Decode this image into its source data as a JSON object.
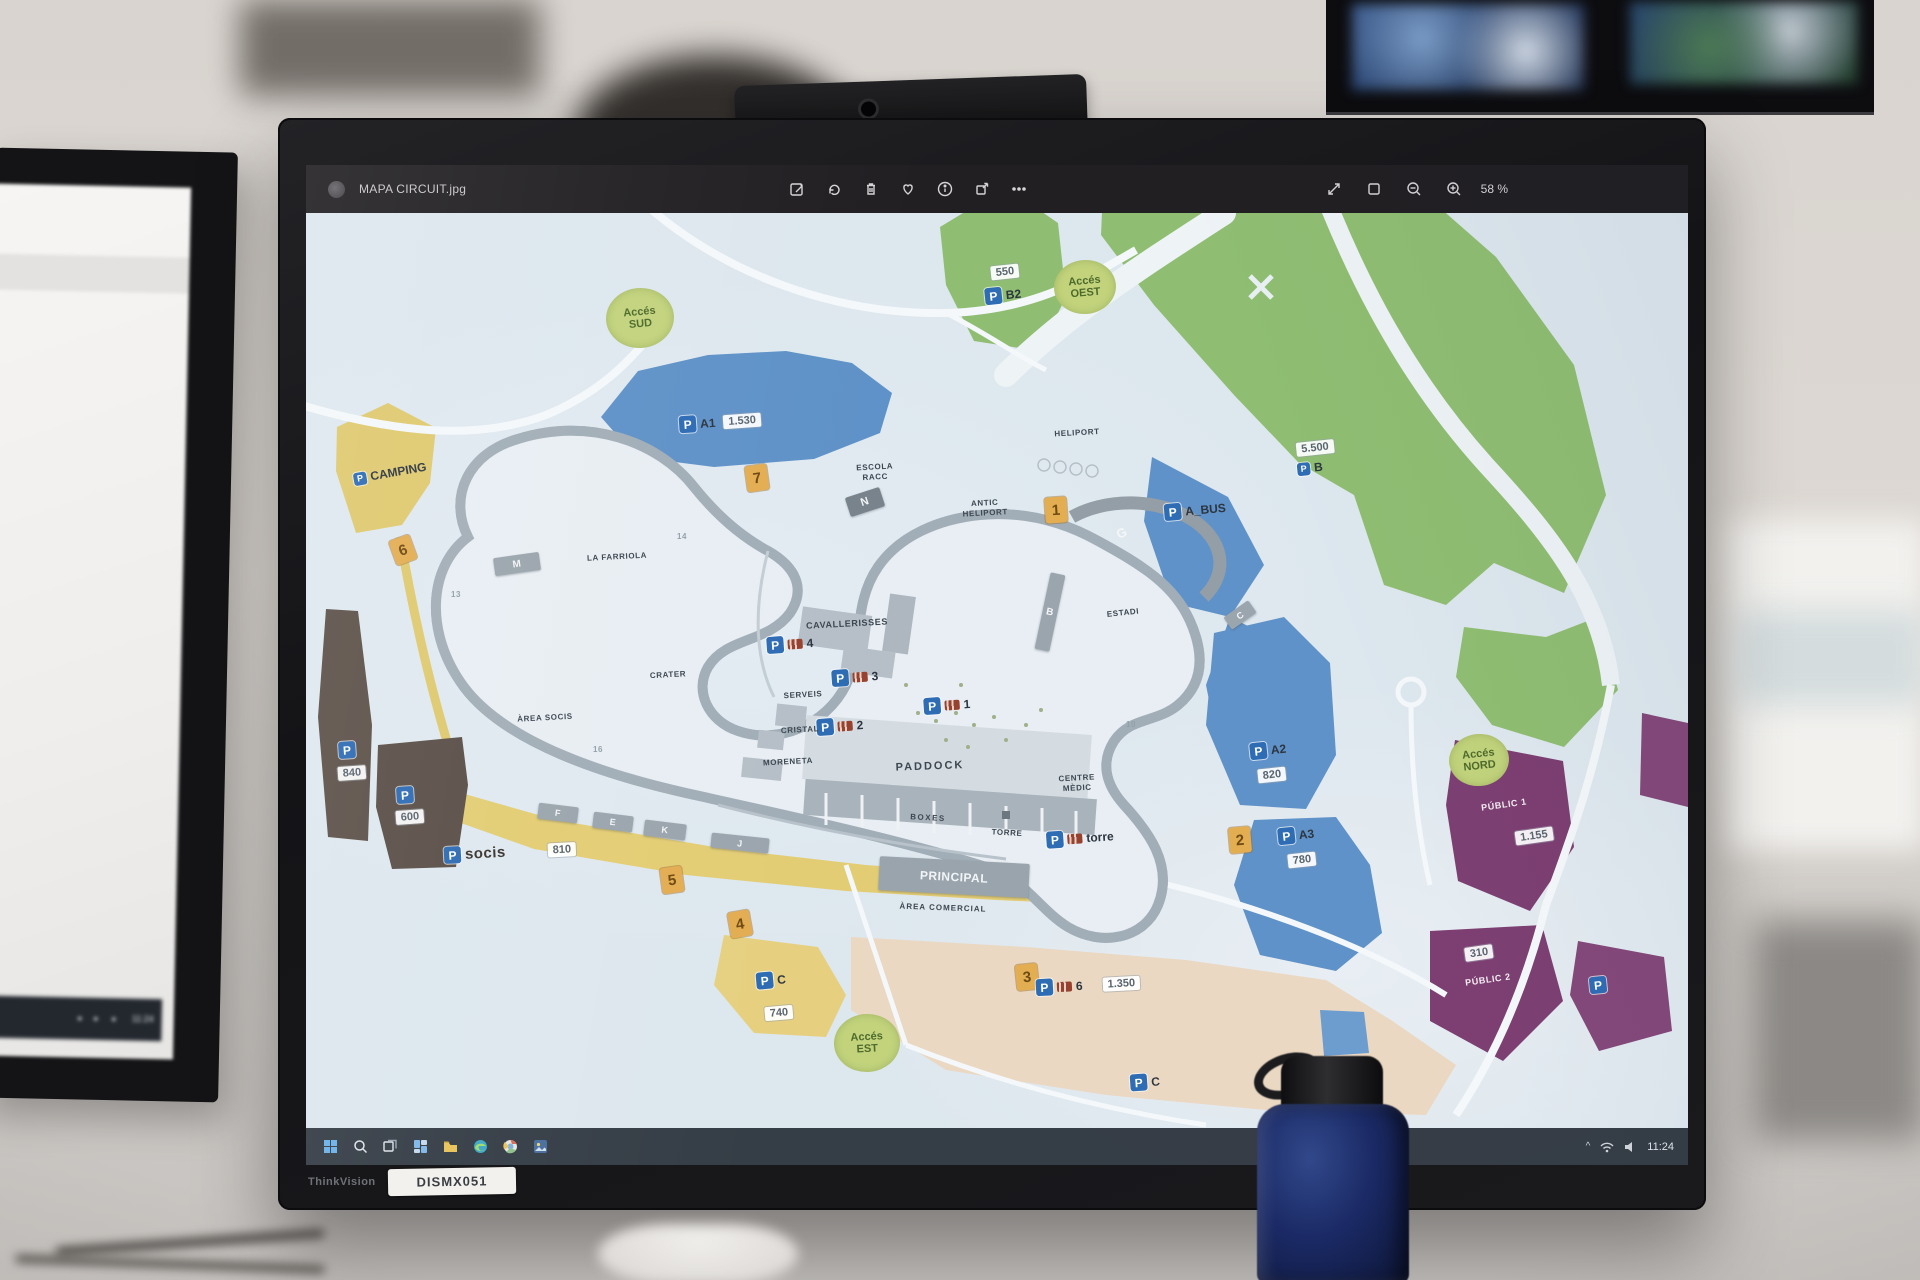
{
  "app": {
    "title": "MAPA CIRCUIT.jpg",
    "toolbar": [
      {
        "name": "edit-icon",
        "label": "Edit"
      },
      {
        "name": "rotate-icon",
        "label": "Rotate"
      },
      {
        "name": "delete-icon",
        "label": "Delete"
      },
      {
        "name": "favorite-icon",
        "label": "Favourite"
      },
      {
        "name": "info-icon",
        "label": "Info"
      },
      {
        "name": "share-icon",
        "label": "Share"
      },
      {
        "name": "more-icon",
        "label": "More"
      }
    ],
    "zoom_controls": [
      "fullscreen",
      "fit-to-window",
      "zoom-out",
      "zoom-in"
    ],
    "zoom_level": "58 %"
  },
  "windows_taskbar": {
    "icons": [
      "start",
      "search",
      "task-view",
      "widgets",
      "file-explorer",
      "edge",
      "chrome",
      "photos"
    ],
    "tray_caret": "^",
    "time": "11:24"
  },
  "left_monitor": {
    "time": "11:24"
  },
  "monitor": {
    "brand": "ThinkVision",
    "asset_tag": "DISMX051"
  },
  "map": {
    "colors": {
      "background": "#dde7ee",
      "vegetation_green": "#8fbe72",
      "parking_blue": "#5f92c8",
      "p_badge_blue": "#2e6cb4",
      "camping_yellow": "#dfc96f",
      "commercial_beige": "#ead8c2",
      "parking_brown": "#5d524a",
      "public_purple": "#7d3f72",
      "access_circle_green": "#c2d37c",
      "gate_orange": "#e3ad52"
    },
    "access_points": [
      {
        "t": "access",
        "lines": [
          "Accés",
          "SUD"
        ],
        "x": 334,
        "y": 153,
        "rx": 34,
        "ry": 30,
        "rot": -5
      },
      {
        "t": "access",
        "lines": [
          "Accés",
          "OEST"
        ],
        "x": 779,
        "y": 122,
        "rx": 31,
        "ry": 27,
        "rot": -5
      },
      {
        "t": "access",
        "lines": [
          "Accés",
          "NORD"
        ],
        "x": 1173,
        "y": 595,
        "rx": 30,
        "ry": 26,
        "rot": -6
      },
      {
        "t": "access",
        "lines": [
          "Accés",
          "EST"
        ],
        "x": 561,
        "y": 878,
        "rx": 33,
        "ry": 29,
        "rot": -3
      }
    ],
    "gates": [
      {
        "t": "gate",
        "n": "1",
        "x": 750,
        "y": 345,
        "rot": -4
      },
      {
        "t": "gate",
        "n": "2",
        "x": 934,
        "y": 675,
        "rot": -5
      },
      {
        "t": "gate",
        "n": "3",
        "x": 721,
        "y": 812,
        "rot": -6
      },
      {
        "t": "gate",
        "n": "4",
        "x": 434,
        "y": 759,
        "rot": -10
      },
      {
        "t": "gate",
        "n": "5",
        "x": 366,
        "y": 715,
        "rot": -8
      },
      {
        "t": "gate",
        "n": "6",
        "x": 97,
        "y": 385,
        "rot": -20
      },
      {
        "t": "gate",
        "n": "7",
        "x": 451,
        "y": 313,
        "rot": -8
      }
    ],
    "parking_badges": [
      {
        "t": "p",
        "x": 414,
        "y": 257,
        "kind": "text",
        "text": "A1",
        "badge": "1.530",
        "rot": -4
      },
      {
        "t": "wbadge",
        "x": 699,
        "y": 107,
        "text": "550",
        "rot": -6
      },
      {
        "t": "p",
        "x": 697,
        "y": 130,
        "kind": "text",
        "text": "B2",
        "rot": -6
      },
      {
        "t": "wbadge",
        "x": 1009,
        "y": 283,
        "text": "5.500",
        "rot": -6
      },
      {
        "t": "p",
        "x": 1004,
        "y": 303,
        "kind": "text",
        "text": "B",
        "small": true,
        "rot": -6
      },
      {
        "t": "p",
        "x": 889,
        "y": 345,
        "kind": "text",
        "text": "A_BUS",
        "rot": -5
      },
      {
        "t": "p",
        "x": 84,
        "y": 308,
        "kind": "text",
        "text": "CAMPING",
        "small": true,
        "rot": -10
      },
      {
        "t": "p",
        "x": 484,
        "y": 479,
        "kind": "bus",
        "num": "4",
        "rot": -4
      },
      {
        "t": "p",
        "x": 549,
        "y": 512,
        "kind": "bus",
        "num": "3",
        "rot": -4
      },
      {
        "t": "p",
        "x": 534,
        "y": 561,
        "kind": "bus",
        "num": "2",
        "rot": -4
      },
      {
        "t": "p",
        "x": 641,
        "y": 540,
        "kind": "bus",
        "num": "1",
        "rot": -4
      },
      {
        "t": "p",
        "x": 774,
        "y": 673,
        "kind": "bus",
        "num": "torre",
        "rot": -4
      },
      {
        "t": "p",
        "x": 782,
        "y": 820,
        "kind": "bus",
        "num": "6",
        "badge": "1.350",
        "badgegap": 16,
        "rot": -3
      },
      {
        "t": "p",
        "x": 204,
        "y": 687,
        "kind": "text",
        "text": "socis",
        "big": true,
        "badge": "810",
        "badgegap": 38,
        "rot": -3
      },
      {
        "t": "p",
        "x": 465,
        "y": 815,
        "kind": "text",
        "text": "C",
        "rot": -5
      },
      {
        "t": "wbadge",
        "x": 473,
        "y": 848,
        "text": "740",
        "rot": -5
      },
      {
        "t": "p",
        "x": 839,
        "y": 917,
        "kind": "text",
        "text": "C",
        "rot": -4
      },
      {
        "t": "p",
        "x": 962,
        "y": 585,
        "kind": "text",
        "text": "A2",
        "rot": -6
      },
      {
        "t": "wbadge",
        "x": 966,
        "y": 610,
        "text": "820",
        "rot": -6
      },
      {
        "t": "p",
        "x": 990,
        "y": 670,
        "kind": "text",
        "text": "A3",
        "rot": -6
      },
      {
        "t": "wbadge",
        "x": 996,
        "y": 695,
        "text": "780",
        "rot": -6
      },
      {
        "t": "p",
        "x": 41,
        "y": 585,
        "kind": "plain",
        "rot": -4
      },
      {
        "t": "wbadge",
        "x": 46,
        "y": 608,
        "text": "840",
        "rot": -4
      },
      {
        "t": "p",
        "x": 99,
        "y": 630,
        "kind": "plain",
        "rot": -4
      },
      {
        "t": "wbadge",
        "x": 104,
        "y": 652,
        "text": "600",
        "rot": -4
      },
      {
        "t": "wbadge",
        "x": 1173,
        "y": 788,
        "text": "310",
        "rot": -8
      },
      {
        "t": "wbadge",
        "x": 1228,
        "y": 671,
        "text": "1.155",
        "rot": -8
      },
      {
        "t": "p",
        "x": 1292,
        "y": 820,
        "kind": "plain",
        "rot": -6
      }
    ],
    "area_labels": [
      {
        "t": "lbl",
        "x": 311,
        "y": 392,
        "text": "LA FARRIOLA",
        "fs": 8,
        "rot": -3
      },
      {
        "t": "lbl",
        "x": 569,
        "y": 307,
        "lines": [
          "ESCOLA",
          "RACC"
        ],
        "fs": 8,
        "rot": -3
      },
      {
        "t": "lbl",
        "x": 679,
        "y": 343,
        "lines": [
          "ANTIC",
          "HELIPORT"
        ],
        "fs": 8,
        "rot": -3
      },
      {
        "t": "lbl",
        "x": 771,
        "y": 268,
        "text": "HELIPORT",
        "fs": 8,
        "rot": -3
      },
      {
        "t": "lbl",
        "x": 362,
        "y": 510,
        "text": "CRATER",
        "fs": 8,
        "rot": -3
      },
      {
        "t": "lbl",
        "x": 239,
        "y": 553,
        "text": "ÀREA SOCIS",
        "fs": 8,
        "rot": -3
      },
      {
        "t": "lbl",
        "x": 497,
        "y": 530,
        "text": "SERVEIS",
        "fs": 8,
        "rot": -3
      },
      {
        "t": "lbl",
        "x": 494,
        "y": 565,
        "text": "CRISTAL",
        "fs": 8,
        "rot": -3
      },
      {
        "t": "lbl",
        "x": 482,
        "y": 597,
        "text": "MORENETA",
        "fs": 8,
        "rot": -3
      },
      {
        "t": "lbl",
        "x": 541,
        "y": 459,
        "text": "CAVALLERISSES",
        "fs": 9,
        "rot": -3
      },
      {
        "t": "lbl",
        "x": 624,
        "y": 602,
        "text": "PADDOCK",
        "fs": 11,
        "ls": 2,
        "rot": -2
      },
      {
        "t": "lbl",
        "x": 622,
        "y": 653,
        "text": "BOXES",
        "fs": 8,
        "ls": 1.5,
        "rot": 3
      },
      {
        "t": "lbl",
        "x": 701,
        "y": 668,
        "text": "TORRE",
        "fs": 8,
        "rot": 3
      },
      {
        "t": "lbl",
        "x": 771,
        "y": 618,
        "lines": [
          "CENTRE",
          "MÈDIC"
        ],
        "fs": 8,
        "rot": -3
      },
      {
        "t": "lbl",
        "x": 637,
        "y": 743,
        "text": "ÀREA COMERCIAL",
        "fs": 8,
        "ls": 1,
        "rot": 2
      },
      {
        "t": "lbl",
        "x": 817,
        "y": 448,
        "text": "ESTADI",
        "fs": 8,
        "rot": -6
      },
      {
        "t": "lbl",
        "x": 1198,
        "y": 640,
        "text": "PÚBLIC 1",
        "fs": 9,
        "color": "#f4eef2",
        "rot": -8
      },
      {
        "t": "lbl",
        "x": 1182,
        "y": 815,
        "text": "PÚBLIC 2",
        "fs": 9,
        "color": "#f4eef2",
        "rot": -8
      },
      {
        "t": "lbl",
        "x": 816,
        "y": 368,
        "text": "G",
        "fs": 13,
        "color": "#f4f6f8",
        "rot": -25
      },
      {
        "t": "lbl",
        "x": 376,
        "y": 372,
        "text": "14",
        "fs": 8,
        "color": "#93a0a9",
        "rot": 0
      },
      {
        "t": "lbl",
        "x": 150,
        "y": 430,
        "text": "13",
        "fs": 8,
        "color": "#93a0a9",
        "rot": 0
      },
      {
        "t": "lbl",
        "x": 292,
        "y": 585,
        "text": "16",
        "fs": 8,
        "color": "#93a0a9",
        "rot": 0
      },
      {
        "t": "lbl",
        "x": 825,
        "y": 560,
        "text": "10",
        "fs": 8,
        "color": "#93a0a9",
        "rot": 0
      }
    ],
    "grandstands": [
      {
        "t": "stand",
        "x": 559,
        "y": 337,
        "w": 36,
        "h": 20,
        "text": "N",
        "fs": 11,
        "rot": -18,
        "bg": "#79838c"
      },
      {
        "t": "stand",
        "x": 211,
        "y": 399,
        "w": 46,
        "h": 18,
        "text": "M",
        "fs": 10,
        "rot": -8
      },
      {
        "t": "stand",
        "x": 744,
        "y": 447,
        "w": 15,
        "h": 78,
        "text": "B",
        "fs": 10,
        "rot": 12
      },
      {
        "t": "stand",
        "x": 934,
        "y": 450,
        "w": 30,
        "h": 15,
        "text": "C",
        "fs": 9,
        "rot": -35
      },
      {
        "t": "stand",
        "x": 252,
        "y": 648,
        "w": 40,
        "h": 16,
        "text": "F",
        "fs": 9,
        "rot": 7
      },
      {
        "t": "stand",
        "x": 307,
        "y": 657,
        "w": 40,
        "h": 16,
        "text": "E",
        "fs": 9,
        "rot": 7
      },
      {
        "t": "stand",
        "x": 359,
        "y": 665,
        "w": 42,
        "h": 16,
        "text": "K",
        "fs": 9,
        "rot": 7
      },
      {
        "t": "stand",
        "x": 434,
        "y": 678,
        "w": 58,
        "h": 15,
        "text": "J",
        "fs": 9,
        "rot": 6
      },
      {
        "t": "stand",
        "x": 648,
        "y": 712,
        "w": 150,
        "h": 34,
        "text": "PRINCIPAL",
        "fs": 12,
        "rot": 3,
        "bg": "#9aa4ad"
      }
    ]
  }
}
